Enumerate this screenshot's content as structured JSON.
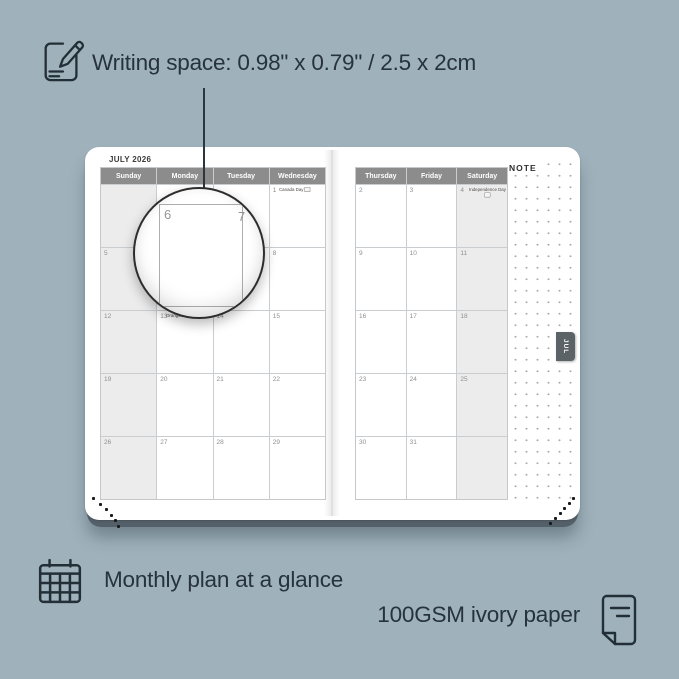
{
  "colors": {
    "background": "#9fb1bb",
    "ink": "#26333c",
    "weekday_header": "#8c8c8c",
    "shaded_column": "#ececec",
    "month_tab": "#5b6367",
    "book_cover_edge": "#546069"
  },
  "features": {
    "writing_space": "Writing space: 0.98\" x 0.79\" / 2.5 x 2cm",
    "monthly_plan": "Monthly plan at a glance",
    "paper": "100GSM ivory paper"
  },
  "icons": [
    "pencil-note-icon",
    "calendar-grid-icon",
    "paper-sheet-icon",
    "flag-icon"
  ],
  "planner": {
    "month_title": "JULY 2026",
    "note_label": "NOTE",
    "month_tab": "JUL",
    "left_page": {
      "headers": [
        "Sunday",
        "Monday",
        "Tuesday",
        "Wednesday"
      ],
      "weeks": [
        [
          "",
          "",
          "",
          {
            "date": "1",
            "holiday": "Canada Day",
            "flag": "inline"
          }
        ],
        [
          "5",
          "6",
          "7",
          "8"
        ],
        [
          "12",
          {
            "date": "13",
            "holiday": "Orangemen's Day",
            "flag": "inline"
          },
          "14",
          "15"
        ],
        [
          "19",
          "20",
          "21",
          "22"
        ],
        [
          "26",
          "27",
          "28",
          "29"
        ]
      ]
    },
    "right_page": {
      "headers": [
        "Thursday",
        "Friday",
        "Saturday"
      ],
      "weeks": [
        [
          "2",
          "3",
          {
            "date": "4",
            "holiday": "Independence Day",
            "flag": "below"
          }
        ],
        [
          "9",
          "10",
          "11"
        ],
        [
          "16",
          "17",
          "18"
        ],
        [
          "23",
          "24",
          "25"
        ],
        [
          "30",
          "31",
          ""
        ]
      ]
    },
    "magnifier_dates": [
      "6",
      "7"
    ]
  }
}
